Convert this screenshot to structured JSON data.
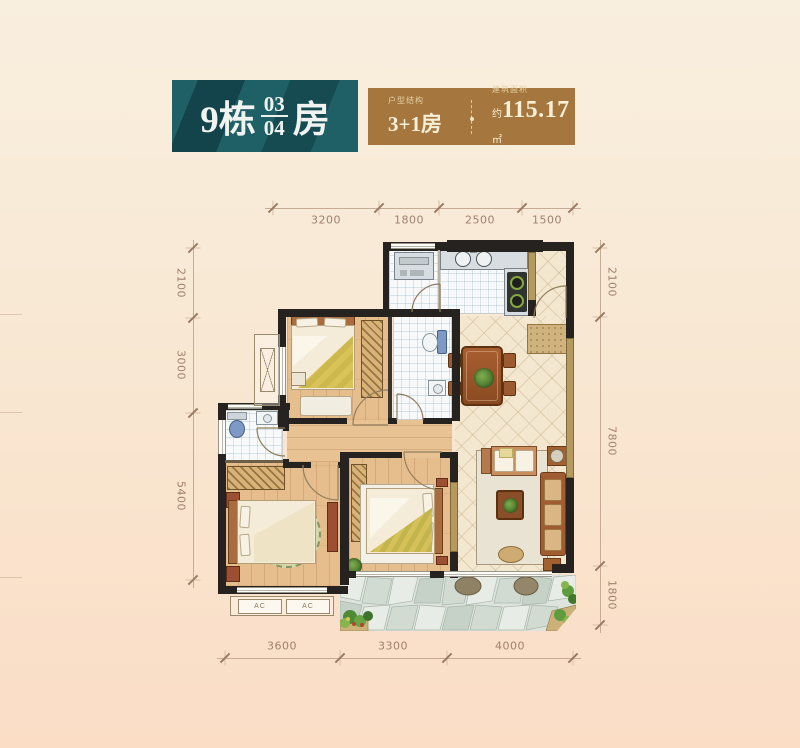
{
  "header": {
    "building": "9栋",
    "unit_top": "03",
    "unit_bottom": "04",
    "unit_suffix": "房",
    "type_label": "户型结构",
    "type_value": "3+1房",
    "area_label": "建筑面积",
    "area_prefix": "约",
    "area_value": "115.17",
    "area_unit": "㎡"
  },
  "dimensions": {
    "top": [
      "3200",
      "1800",
      "2500",
      "1500"
    ],
    "bottom": [
      "3600",
      "3300",
      "4000"
    ],
    "left": [
      "2100",
      "3000",
      "5400"
    ],
    "right": [
      "2100",
      "7800",
      "1800"
    ]
  },
  "labels": {
    "ac": "AC"
  },
  "colors": {
    "accent_teal": "#1f5f66",
    "accent_bronze": "#a5773f",
    "wall_black": "#262220",
    "wood_floor": "#e6bd8d",
    "beige_tile": "#f3e7cf",
    "balcony_stone": "#dde4dd",
    "dim_text": "#a1806f"
  }
}
